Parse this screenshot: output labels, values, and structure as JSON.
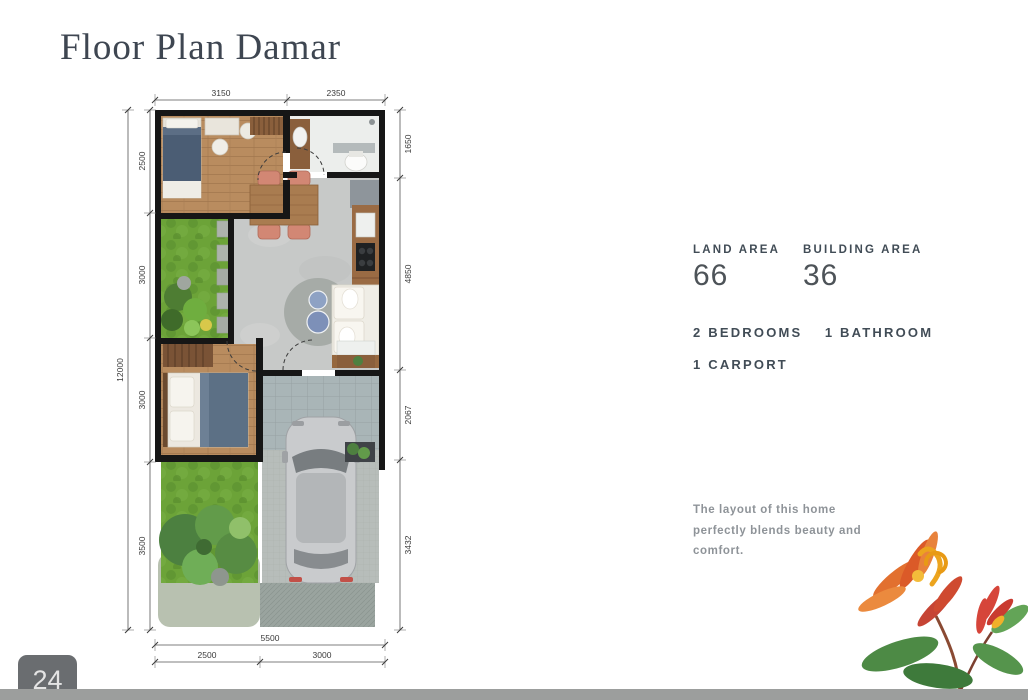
{
  "page": {
    "title": "Floor Plan Damar",
    "page_number": "24"
  },
  "specs": {
    "land_area": {
      "label": "LAND AREA",
      "value": "66"
    },
    "building_area": {
      "label": "BUILDING AREA",
      "value": "36"
    },
    "features": {
      "bedrooms": "2 BEDROOMS",
      "bathroom": "1 BATHROOM",
      "carport": "1 CARPORT"
    },
    "description": "The layout of this home perfectly blends beauty and comfort."
  },
  "floor_plan": {
    "dims": {
      "top": [
        "3150",
        "2350"
      ],
      "left_outer": "12000",
      "left_inner": [
        "2500",
        "3000",
        "3000",
        "3500"
      ],
      "right": [
        "1650",
        "4850",
        "2067",
        "3432"
      ],
      "bottom_total": "5500",
      "bottom_segments": [
        "2500",
        "3000"
      ]
    },
    "colors": {
      "wall": "#161616",
      "wood_floor": "#b98c5f",
      "concrete_floor": "#c7c9c8",
      "grass": "#6ca338",
      "carport_tile": "#a9b5b7",
      "chair_accent": "#d28774",
      "bed_navy": "#4b5d74",
      "title_text": "#3e4651",
      "muted_text": "#8e9398"
    }
  }
}
